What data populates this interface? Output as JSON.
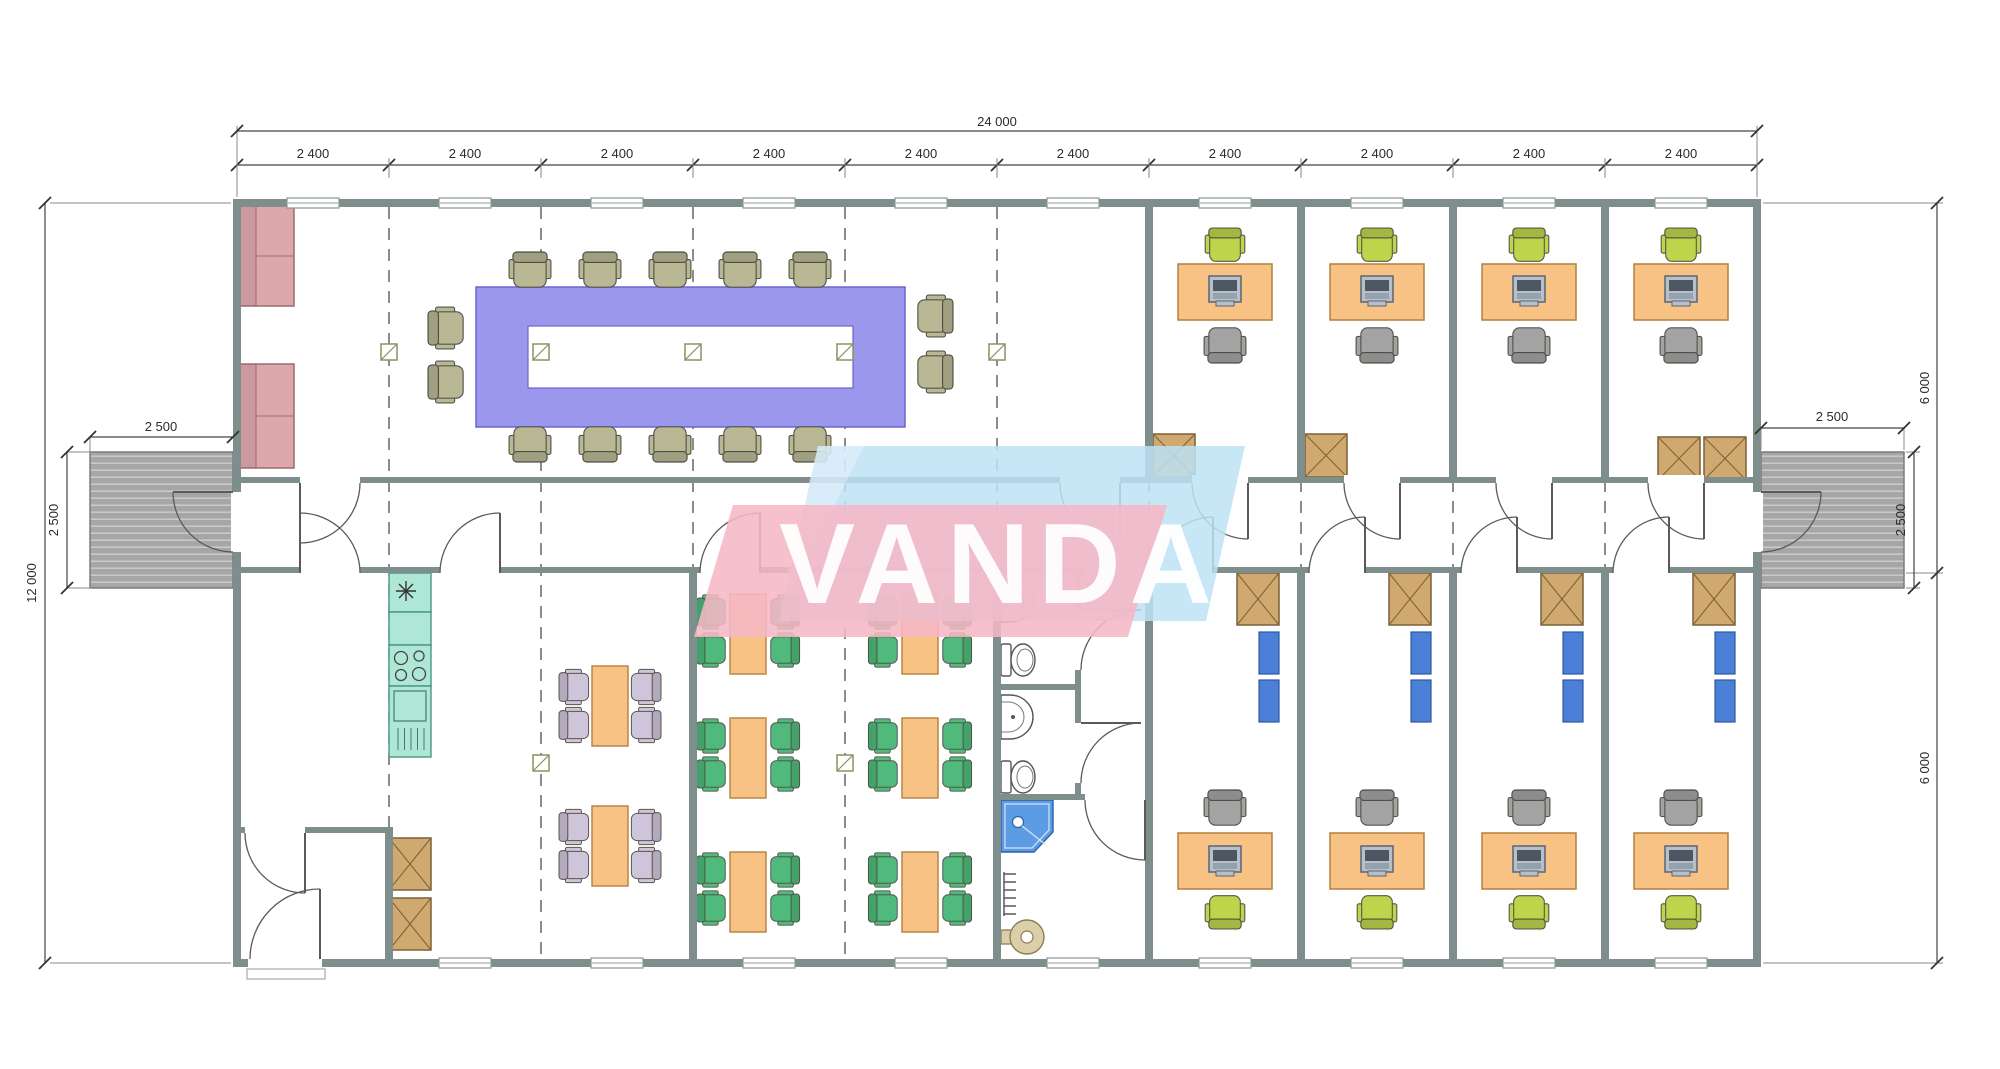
{
  "watermark": {
    "text": "VANDA"
  },
  "dimensions": {
    "total_width": "24 000",
    "modules": [
      "2 400",
      "2 400",
      "2 400",
      "2 400",
      "2 400",
      "2 400",
      "2 400",
      "2 400",
      "2 400",
      "2 400"
    ],
    "overall_height_left": "12 000",
    "right_top_height": "6 000",
    "right_bottom_height": "6 000",
    "left_deck": {
      "width": "2 500",
      "depth": "2 500"
    },
    "right_deck": {
      "width": "2 500",
      "depth": "2 500"
    }
  },
  "colors": {
    "wall": "#7e8e8c",
    "deck": "#a6a6a6",
    "conference_table": "#9b97ec",
    "chair_olive": "#b9b895",
    "sofa": "#dda7ac",
    "desk_orange": "#f8c285",
    "chair_lime": "#bdd44b",
    "chair_gray": "#a3a3a3",
    "chair_green": "#4fba7b",
    "chair_lavender": "#cfc5da",
    "cabinet": "#cfa96f",
    "shelf_blue": "#4c80d8",
    "kitchen_unit": "#afe7d6",
    "shower": "#5c9ce3",
    "boiler": "#dacfa8",
    "watermark_pink": "#f5b7c5",
    "watermark_blue": "#bde2f4",
    "dimension_text": "#2b2b2b"
  }
}
